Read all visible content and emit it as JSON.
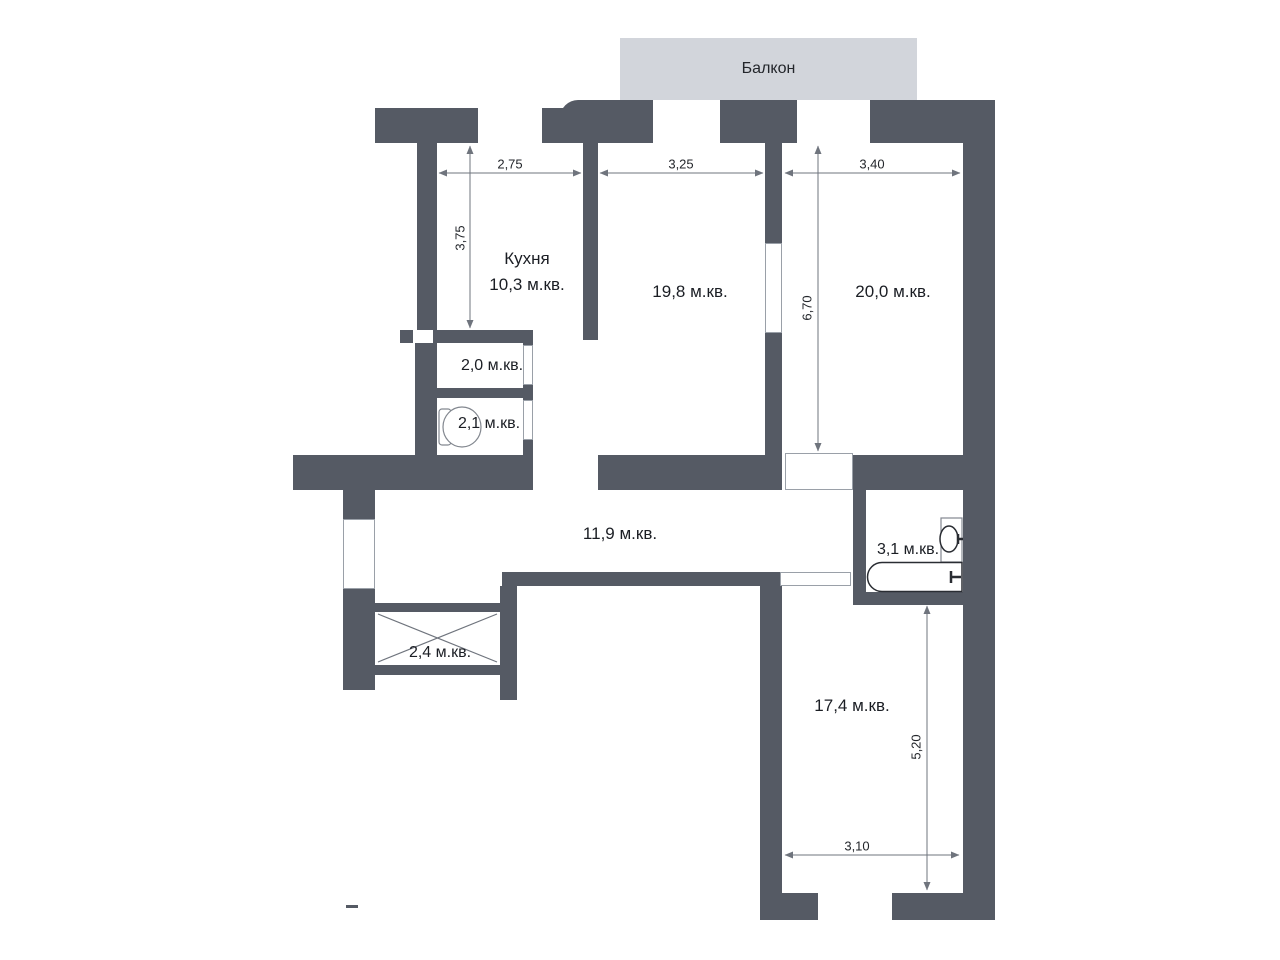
{
  "colors": {
    "wall": "#555a64",
    "balcony": "#d2d5db",
    "line": "#6f747d",
    "text": "#1b1e24"
  },
  "balcony": {
    "label": "Балкон"
  },
  "rooms": {
    "kitchen": {
      "name": "Кухня",
      "area": "10,3 м.кв."
    },
    "living": {
      "area": "19,8 м.кв."
    },
    "bedroom": {
      "area": "20,0 м.кв."
    },
    "storage_small": {
      "area": "2,0 м.кв."
    },
    "wc": {
      "area": "2,1 м.кв."
    },
    "hallway": {
      "area": "11,9 м.кв."
    },
    "bathroom": {
      "area": "3,1 м.кв."
    },
    "closet": {
      "area": "2,4 м.кв."
    },
    "bedroom2": {
      "area": "17,4 м.кв."
    }
  },
  "dimensions": {
    "kitchen_width": "2,75",
    "living_width": "3,25",
    "bedroom_width": "3,40",
    "kitchen_depth": "3,75",
    "bedroom_depth": "6,70",
    "bedroom2_depth": "5,20",
    "bedroom2_width": "3,10"
  }
}
